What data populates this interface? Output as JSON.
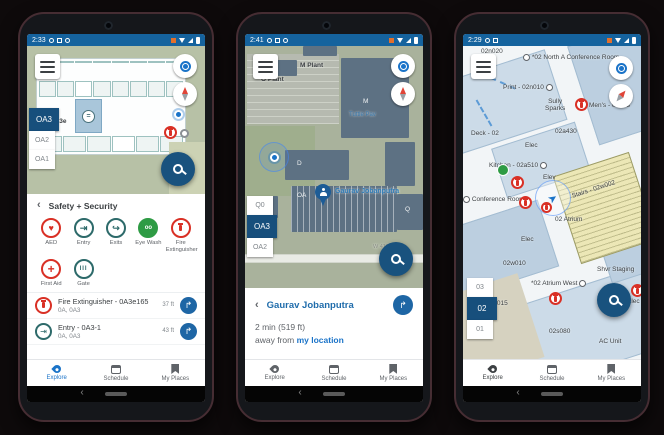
{
  "glyphs": {
    "back": "‹",
    "direction_arrow": "↱",
    "heart": "♥",
    "entry_arrow": "⇥",
    "exit_arrow": "↪",
    "plus": "+",
    "gate_bars": "III",
    "elevator": "=",
    "eye_wash": "oo",
    "location_arrow": "➤"
  },
  "bottom_nav": {
    "explore": "Explore",
    "schedule": "Schedule",
    "my_places": "My Places"
  },
  "p1": {
    "status_time": "2:33",
    "map": {
      "room_label": "0A3e"
    },
    "floors": [
      {
        "label": "OA3"
      },
      {
        "label": "OA2"
      },
      {
        "label": "OA1"
      }
    ],
    "panel_title": "Safety + Security",
    "categories": [
      {
        "label": "AED"
      },
      {
        "label": "Entry"
      },
      {
        "label": "Exits"
      },
      {
        "label": "Eye Wash"
      },
      {
        "label": "Fire Extinguisher"
      },
      {
        "label": "First Aid"
      },
      {
        "label": "Gate"
      }
    ],
    "results": [
      {
        "title": "Fire Extinguisher - 0A3e165",
        "subtitle": "0A, 0A3",
        "distance": "37 ft"
      },
      {
        "title": "Entry - 0A3-1",
        "subtitle": "0A, 0A3",
        "distance": "43 ft"
      }
    ]
  },
  "p2": {
    "status_time": "2:41",
    "labels": {
      "m_plant": "M Plant",
      "o_plant": "O Plant",
      "m": "M",
      "tuttle": "Tuttle Pav",
      "d": "D",
      "oa": "OA",
      "j": "J",
      "q": "Q",
      "street": "W 41ST ST",
      "person": "Gaurav Jobanputra"
    },
    "floors": [
      {
        "label": "Q0"
      },
      {
        "label": "OA3"
      },
      {
        "label": "OA2"
      }
    ],
    "panel": {
      "title": "Gaurav Jobanputra",
      "line1": "2 min (519 ft)",
      "line2_prefix": "away from ",
      "line2_link": "my location"
    }
  },
  "p3": {
    "status_time": "2:29",
    "labels": {
      "n020": "02n020",
      "north_conf": "*02 North A Conference Room",
      "print": "Print - 02n010",
      "sully_1": "Sully",
      "sully_2": "Sparks",
      "mens": "Men's - 02a33",
      "deck": "Deck - 02",
      "a430": "02a430",
      "elec_a": "Elec",
      "kitchen": "Kitchen - 02a510",
      "elev": "Elev",
      "stairs": "Stairs - 02w002",
      "atrium": "02 Atrium",
      "conf_room": "Conference Room",
      "elec_b": "Elec",
      "w010": "02w010",
      "atrium_west": "*02 Atrium West",
      "w015": "02w015",
      "shvr": "Shvr Staging",
      "s080": "02s080",
      "ac_unit": "AC Unit",
      "elec_c": "Elec"
    },
    "floors": [
      {
        "label": "03"
      },
      {
        "label": "02"
      },
      {
        "label": "01"
      }
    ]
  }
}
